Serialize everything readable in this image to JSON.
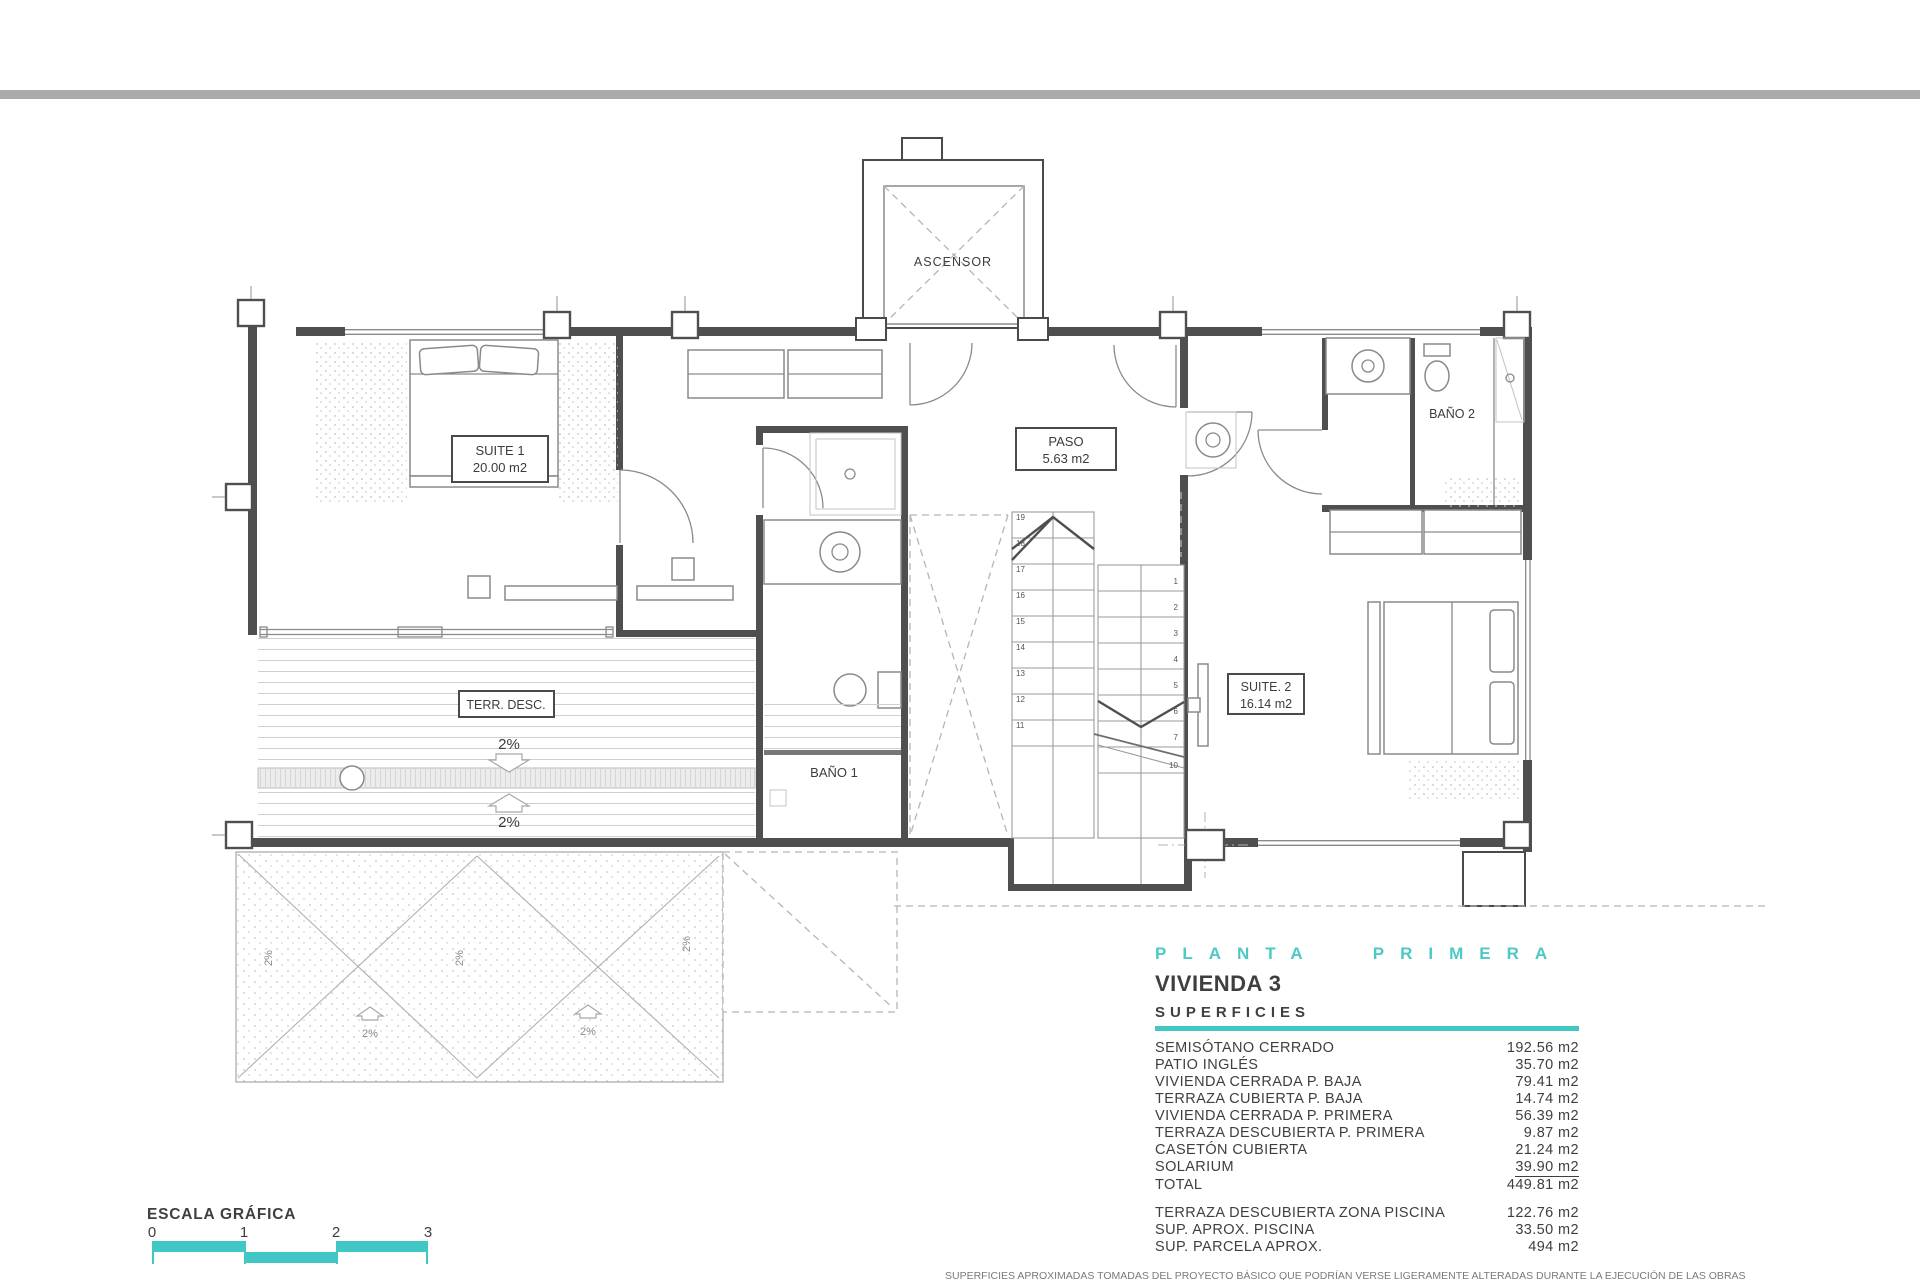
{
  "colors": {
    "accent": "#42c8c4",
    "wall": "#4f4f4f",
    "top_bar": "#ababab"
  },
  "plan": {
    "ascensor": "ASCENSOR",
    "suite1": {
      "name": "SUITE 1",
      "area": "20.00 m2"
    },
    "paso": {
      "name": "PASO",
      "area": "5.63 m2"
    },
    "bano1": "BAÑO 1",
    "bano2": "BAÑO 2",
    "suite2": {
      "name": "SUITE. 2",
      "area": "16.14 m2"
    },
    "terrace": "TERR. DESC.",
    "slope": "2%",
    "stairs": {
      "left": [
        "19",
        "18",
        "17",
        "16",
        "15",
        "14",
        "13",
        "12",
        "11"
      ],
      "right": [
        "1",
        "2",
        "3",
        "4",
        "5",
        "6",
        "7",
        "10"
      ]
    }
  },
  "panel": {
    "plan_title": "PLANTA PRIMERA",
    "dwelling": "VIVIENDA 3",
    "subtitle": "SUPERFICIES",
    "rows": [
      {
        "label": "SEMISÓTANO CERRADO",
        "value": "192.56 m2"
      },
      {
        "label": "PATIO INGLÉS",
        "value": "35.70 m2"
      },
      {
        "label": "VIVIENDA CERRADA P. BAJA",
        "value": "79.41 m2"
      },
      {
        "label": "TERRAZA CUBIERTA P. BAJA",
        "value": "14.74 m2"
      },
      {
        "label": "VIVIENDA CERRADA P. PRIMERA",
        "value": "56.39 m2"
      },
      {
        "label": "TERRAZA DESCUBIERTA P. PRIMERA",
        "value": "9.87 m2"
      },
      {
        "label": "CASETÓN CUBIERTA",
        "value": "21.24 m2"
      },
      {
        "label": "SOLARIUM",
        "value": "39.90 m2"
      },
      {
        "label": "TOTAL",
        "value": "449.81 m2"
      }
    ],
    "extra_rows": [
      {
        "label": "TERRAZA DESCUBIERTA  ZONA PISCINA",
        "value": "122.76 m2"
      },
      {
        "label": "SUP.  APROX.  PISCINA",
        "value": "33.50 m2"
      },
      {
        "label": "SUP. PARCELA APROX.",
        "value": "494 m2"
      }
    ],
    "disclaimer": "SUPERFICIES APROXIMADAS TOMADAS DEL PROYECTO BÁSICO QUE PODRÍAN VERSE LIGERAMENTE ALTERADAS DURANTE LA EJECUCIÓN DE LAS OBRAS"
  },
  "scalebar": {
    "title": "ESCALA GRÁFICA",
    "ticks": [
      "0",
      "1",
      "2",
      "3"
    ]
  }
}
